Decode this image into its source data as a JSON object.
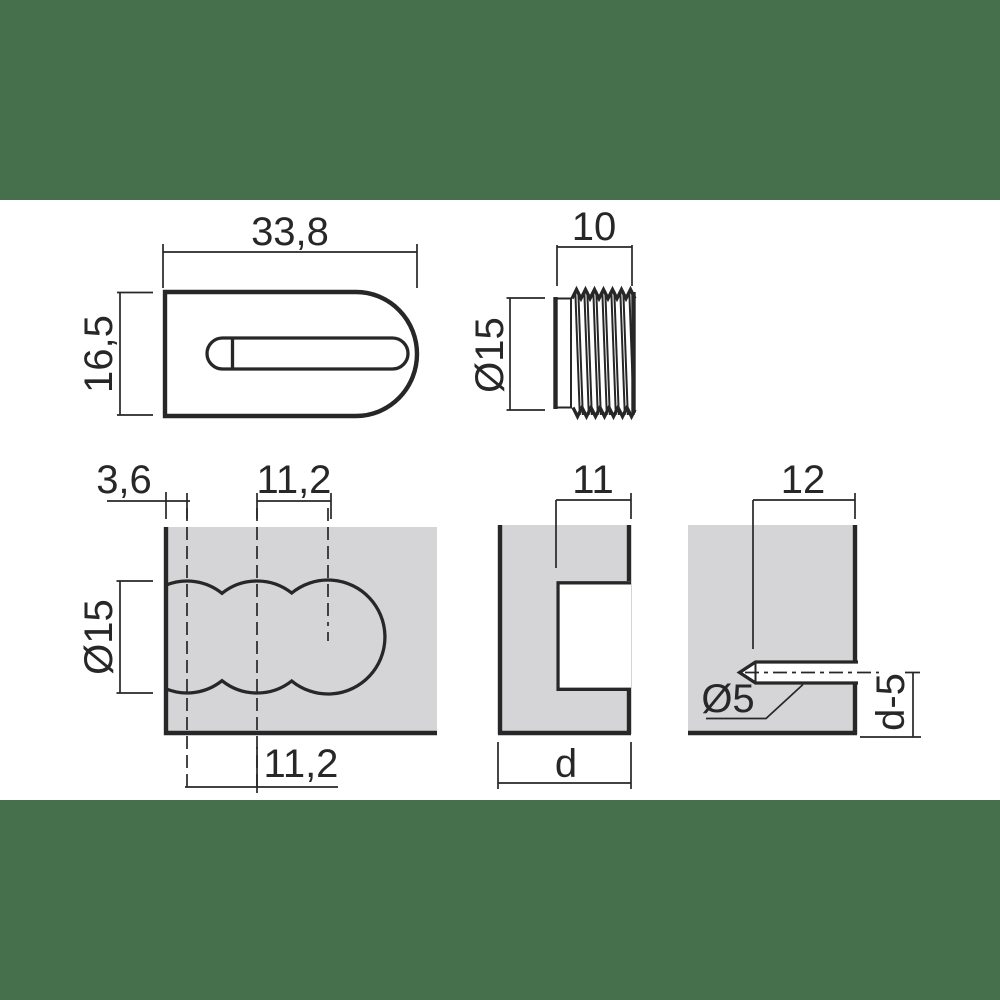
{
  "page": {
    "band_color": "#46704B",
    "background": "#ffffff"
  },
  "drawing": {
    "line_color": "#272727",
    "panel_fill": "#D5D5D7",
    "views": {
      "cam_side_view": {
        "dimensions": {
          "width": "33,8",
          "height": "16,5"
        }
      },
      "cam_front_view": {
        "dimensions": {
          "depth": "10",
          "diameter": "Ø15"
        }
      },
      "panel_plan_view": {
        "dimensions": {
          "edge_distance": "3,6",
          "hole_pitch_upper": "11,2",
          "hole_diameter": "Ø15",
          "hole_pitch_lower": "11,2"
        }
      },
      "panel_section_view": {
        "dimensions": {
          "notch_width": "11",
          "panel_thickness": "d"
        }
      },
      "panel_edge_view": {
        "dimensions": {
          "drill_depth": "12",
          "pilot_hole_diameter": "Ø5",
          "hole_center_offset": "d-5"
        }
      }
    }
  }
}
